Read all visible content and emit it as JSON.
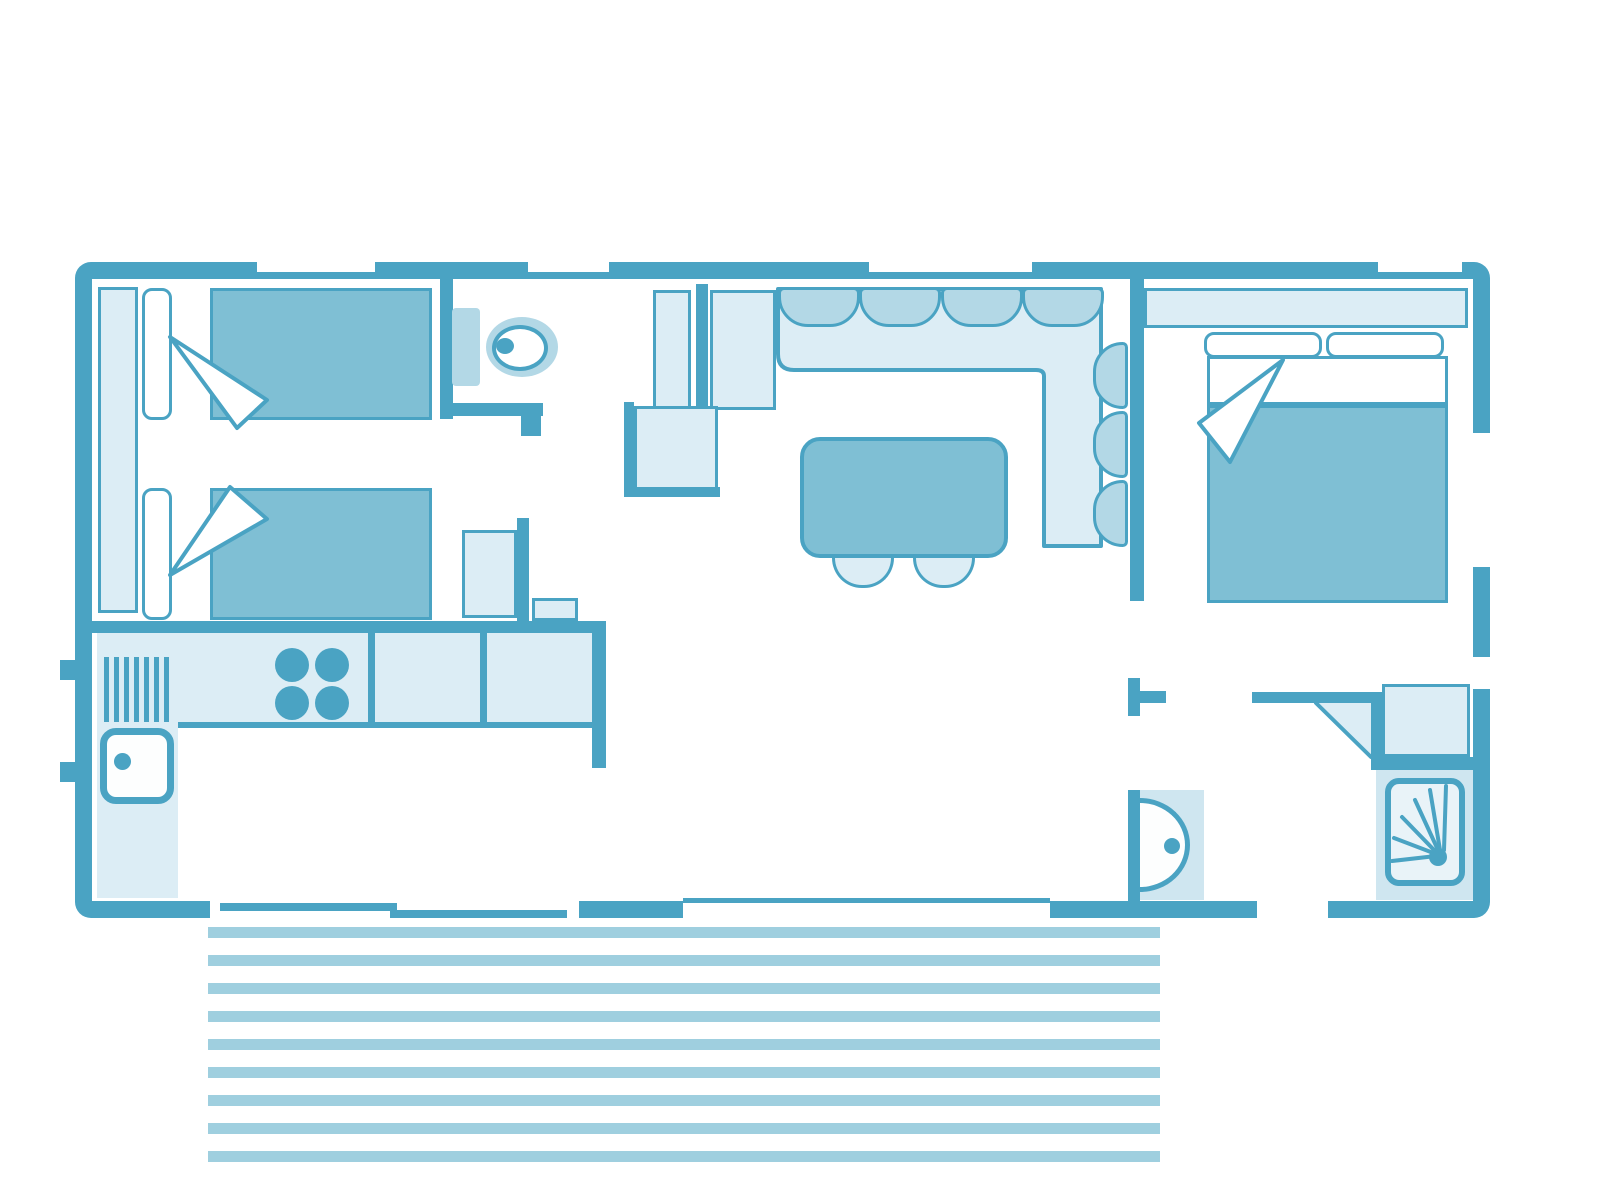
{
  "image_type": "mobile-home-floor-plan",
  "palette": {
    "wall": "#4AA3C3",
    "medium": "#7FBFD4",
    "cushionc": "#B3D8E6",
    "light": "#DCEDF5",
    "pale": "#CFE6F0",
    "paler": "#E9F3F8",
    "stripe": "#9FCFDF"
  },
  "rooms": [
    {
      "name": "twin-bedroom",
      "furniture": [
        "wardrobe",
        "single-bed",
        "single-bed"
      ]
    },
    {
      "name": "wc",
      "furniture": [
        "toilet",
        "cabinet"
      ]
    },
    {
      "name": "kitchen",
      "furniture": [
        "worktop",
        "drainer",
        "hob",
        "sink",
        "base-unit"
      ]
    },
    {
      "name": "entrance",
      "furniture": [
        "tall-cabinet",
        "tall-cabinet",
        "low-cabinet"
      ]
    },
    {
      "name": "living-dining",
      "furniture": [
        "corner-sofa",
        "dining-table",
        "chair",
        "chair"
      ]
    },
    {
      "name": "master-bedroom",
      "furniture": [
        "headboard-shelf",
        "double-bed"
      ]
    },
    {
      "name": "shower-room",
      "furniture": [
        "washbasin",
        "shower",
        "closet"
      ]
    },
    {
      "name": "terrace",
      "furniture": [
        "decking"
      ]
    }
  ],
  "counts": {
    "terrace_boards": 9,
    "hob_burners": 4,
    "drainer_slots": 7,
    "sofa_back_cushions": 4,
    "sofa_side_cushions": 3,
    "dining_chairs": 2,
    "twin_beds": 2,
    "pillows_master": 2,
    "top_windows": 4,
    "shower_spray_rays": 6
  }
}
